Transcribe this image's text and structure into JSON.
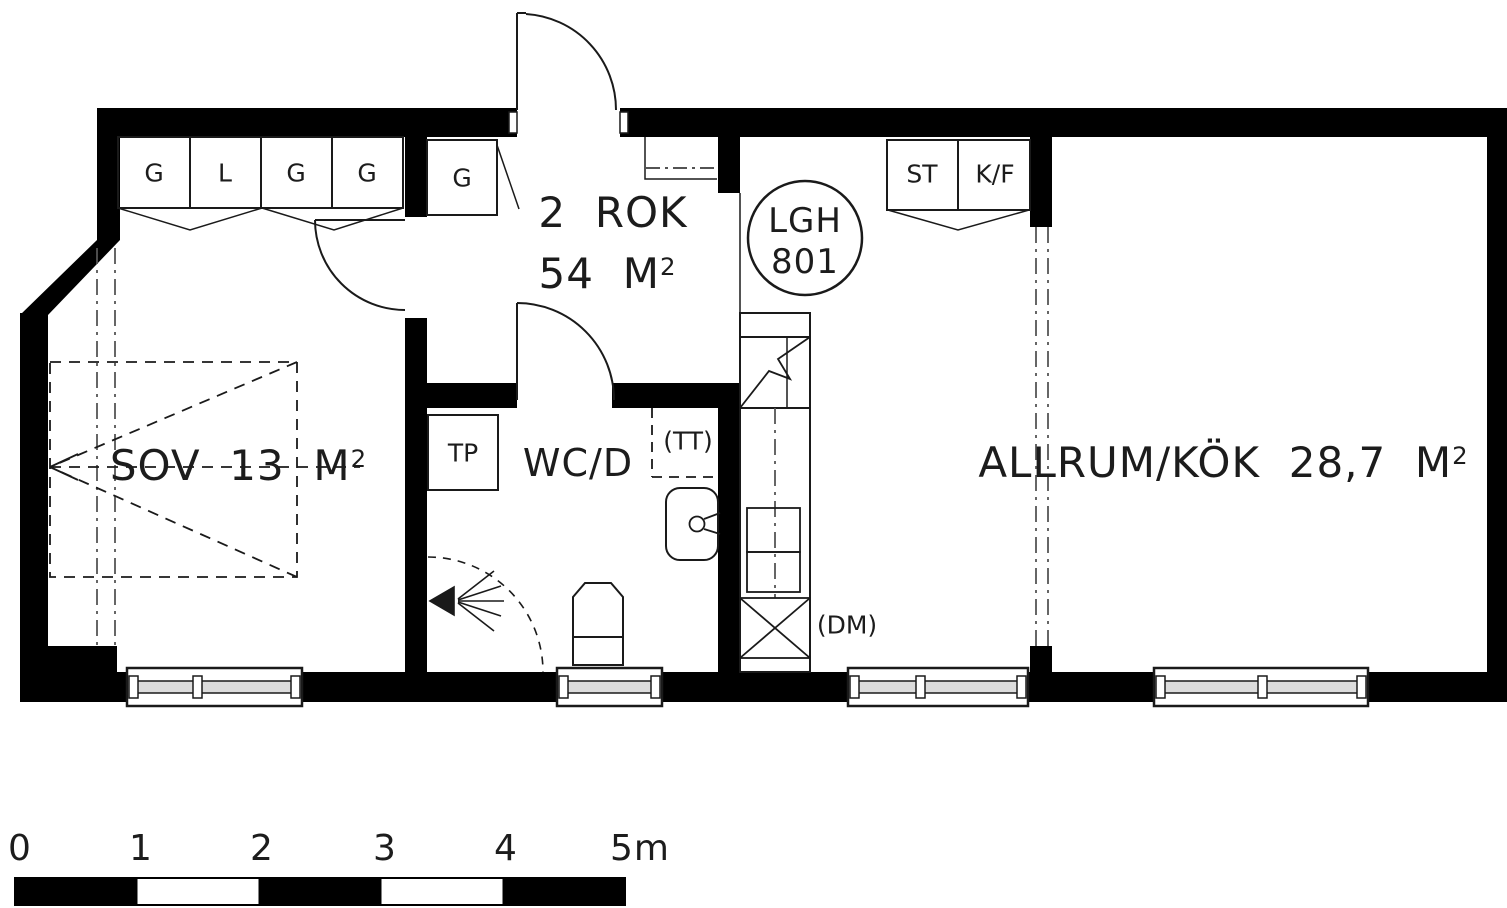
{
  "apartment": {
    "type_label": "2  ROK",
    "area_value": "54  M",
    "area_sup": "2",
    "unit_line1": "LGH",
    "unit_line2": "801"
  },
  "rooms": {
    "bedroom_label": "SOV  13  M",
    "bedroom_sup": "2",
    "bathroom_label": "WC/D",
    "living_kitchen_label": "ALLRUM/KÖK  28,7  M",
    "living_kitchen_sup": "2"
  },
  "closets": {
    "bedroom_1": "G",
    "bedroom_2": "L",
    "bedroom_3": "G",
    "bedroom_4": "G",
    "hall": "G",
    "storage": "ST",
    "fridge_freezer": "K/F"
  },
  "fixtures": {
    "towel_dryer": "TP",
    "washer_space": "(TT)",
    "dishwasher": "(DM)"
  },
  "scale_bar": {
    "l0": "0",
    "l1": "1",
    "l2": "2",
    "l3": "3",
    "l4": "4",
    "l5": "5m"
  },
  "colors": {
    "wall": "#000000",
    "line": "#1a1a1a",
    "glass_band": "#dcdcdc"
  }
}
